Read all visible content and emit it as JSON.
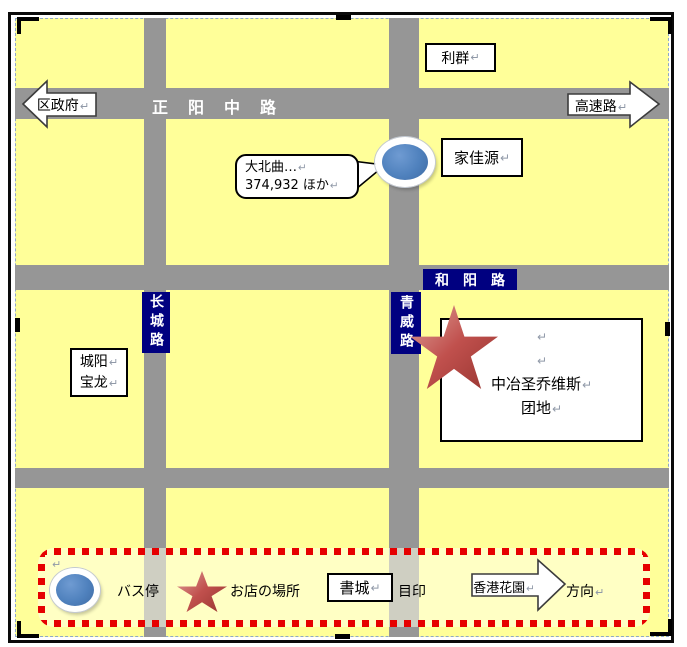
{
  "colors": {
    "block_fill": "#FFFF99",
    "road_gray": "#969696",
    "road_label_bg": "#000080",
    "bus_marker_blue": "#4F81BD",
    "star_red": "#C0504D",
    "legend_border_red": "#E60000",
    "legend_fill": "#FFFFE8"
  },
  "marks": {
    "return_mark": "↵"
  },
  "roads": {
    "zhengyang": "正　阳　中　路",
    "heyang": "和　阳　路",
    "changcheng": "长城路",
    "qingwei": "青威路"
  },
  "places": {
    "liqun": "利群",
    "jiajiayuan": "家佳源",
    "chengyang_line1": "城阳",
    "chengyang_line2": "宝龙",
    "complex_line1": "中冶圣乔维斯",
    "complex_line2": "团地"
  },
  "arrows": {
    "district_government": "区政府",
    "expressway": "高速路",
    "hongkong_garden": "香港花園"
  },
  "bubble": {
    "line1": "大北曲…",
    "line2": "374,932 ほか"
  },
  "legend": {
    "bus_stop": "バス停",
    "shop_location": "お店の場所",
    "bookcity": "書城",
    "landmark": "目印",
    "direction": "方向"
  }
}
